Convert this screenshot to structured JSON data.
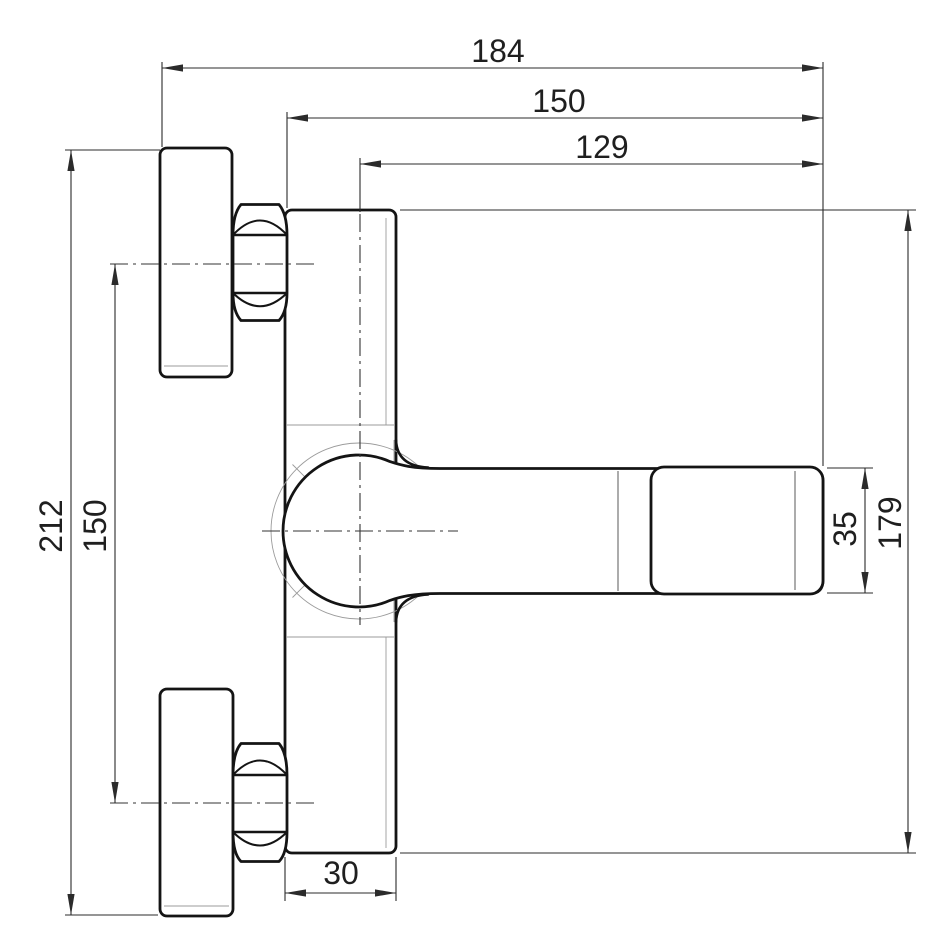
{
  "drawing": {
    "kind": "technical-dimension-drawing",
    "part": "wall-mounted-single-lever-mixer-side-view",
    "line_colors": {
      "outline": "#141414",
      "dimension": "#2b2b2b",
      "construction": "#9b9b9b",
      "background": "#ffffff"
    },
    "dimensions": {
      "d184": {
        "label": "184",
        "orientation": "horizontal",
        "position": "top"
      },
      "d150_top": {
        "label": "150",
        "orientation": "horizontal",
        "position": "top"
      },
      "d129": {
        "label": "129",
        "orientation": "horizontal",
        "position": "top"
      },
      "d212": {
        "label": "212",
        "orientation": "vertical",
        "position": "left"
      },
      "d150_left": {
        "label": "150",
        "orientation": "vertical",
        "position": "left"
      },
      "d35": {
        "label": "35",
        "orientation": "vertical",
        "position": "right"
      },
      "d179": {
        "label": "179",
        "orientation": "vertical",
        "position": "right"
      },
      "d30": {
        "label": "30",
        "orientation": "horizontal",
        "position": "bottom"
      }
    }
  }
}
